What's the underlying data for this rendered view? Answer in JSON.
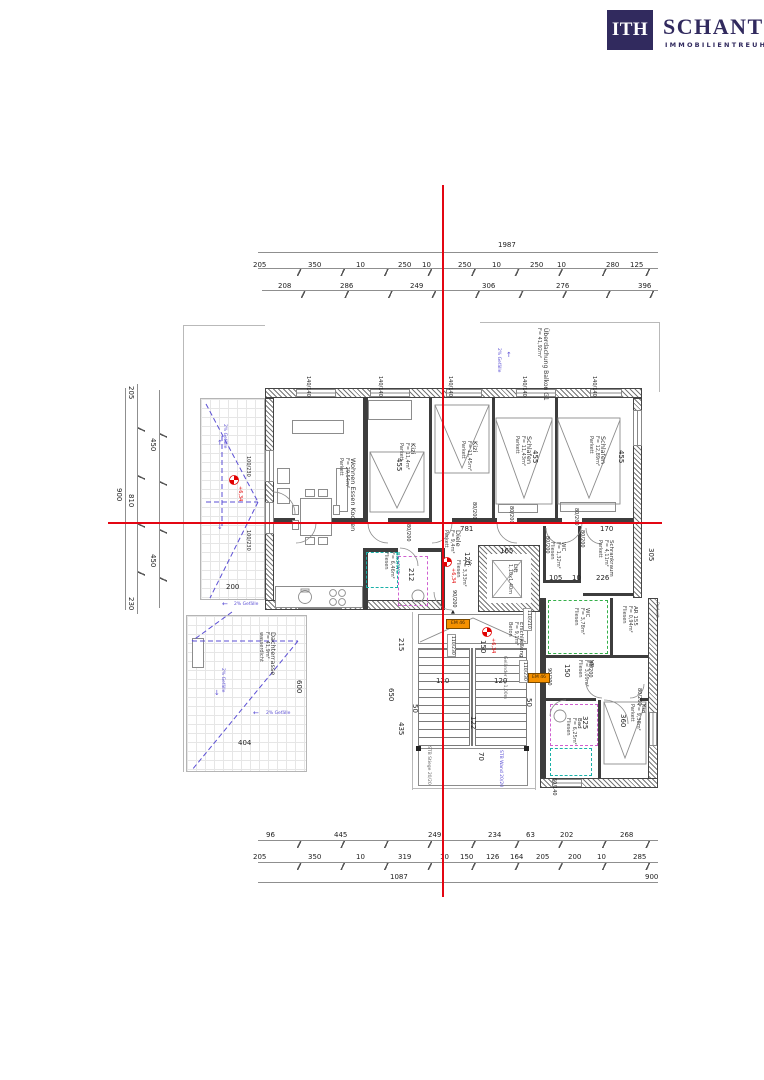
{
  "logo": {
    "abbr": "ITH",
    "name": "SCHANTL",
    "subtitle": "IMMOBILIENTREUHAND"
  },
  "dims": {
    "top": {
      "total": "1987",
      "row2": [
        "205",
        "350",
        "10",
        "250",
        "10",
        "250",
        "10",
        "250",
        "10",
        "280",
        "125"
      ],
      "row3": [
        "208",
        "286",
        "249",
        "306",
        "276",
        "396"
      ]
    },
    "bottom": {
      "row1": [
        "96",
        "445",
        "249",
        "234",
        "63",
        "202",
        "268"
      ],
      "row2": [
        "205",
        "350",
        "10",
        "319",
        "10",
        "150",
        "126",
        "164",
        "205",
        "200",
        "10",
        "285"
      ],
      "row3": [
        "1087",
        "900"
      ]
    },
    "left": {
      "total": "900",
      "segments": [
        "205",
        "450",
        "810",
        "450",
        "230"
      ]
    }
  },
  "rooms": {
    "wohnen": {
      "name": "Wohnen Essen Kochen",
      "area": "F= 29,54m²",
      "floor": "Parkett"
    },
    "kizi_a": {
      "name": "Kizi",
      "area": "F= 11,4m²",
      "floor": "Parkett"
    },
    "kizi_b": {
      "name": "Kizi",
      "area": "F= 11,45m²",
      "floor": "Parkett"
    },
    "schlafen_a": {
      "name": "Schlafen",
      "area": "F= 11,43m²",
      "floor": "Parkett"
    },
    "schlafen_b": {
      "name": "Schlafen",
      "area": "F= 12,89m²",
      "floor": "Parkett"
    },
    "diele": {
      "name": "Diele",
      "area": "F= 9,4m²",
      "floor": "Parkett"
    },
    "vr_a": {
      "name": "Vr.",
      "area": "F= 3,33m²",
      "floor": "Fliesen"
    },
    "lift": {
      "name": "Lift",
      "size": "1,10x1,40m"
    },
    "wc_a": {
      "name": "WC",
      "area": "F= 1,32m²",
      "floor": "Fliesen"
    },
    "schrankraum": {
      "name": "Schrankraum",
      "area": "F= 4,11m²",
      "floor": "Parkett"
    },
    "badwc": {
      "name": "Bad/WC",
      "area": "F= 6,46m²",
      "floor": "Fliesen"
    },
    "erschliessung": {
      "name": "Erschließung",
      "area": "F= 9,1m²",
      "floor": "Beton"
    },
    "wc_b": {
      "name": "WC",
      "area": "F= 3,78m²",
      "floor": "Fliesen"
    },
    "ar": {
      "name": "AR 155",
      "area": "F= 0,94m²",
      "floor": "Fliesen"
    },
    "vr_b": {
      "name": "VR",
      "area": "F= 3,09m²",
      "floor": "Fliesen"
    },
    "bad": {
      "name": "Bad",
      "area": "F= 6,25m²",
      "floor": "Fliesen"
    },
    "kizi_c": {
      "name": "Kizi",
      "area": "F= 9,38m²",
      "floor": "Parkett"
    },
    "dachterrasse": {
      "name": "Dachterrasse",
      "area": "F= 41,9m²",
      "note": "wasserdicht"
    },
    "balkon": {
      "name": "Überdachung Balkon G1",
      "area": "F= 41,92m²"
    }
  },
  "plan_dims": {
    "w455": "455",
    "w781": "781",
    "w170": "170",
    "h305": "305",
    "h120": "120",
    "w105": "105",
    "w10": "10",
    "w226": "226",
    "w165": "165",
    "h212": "212",
    "h215": "215",
    "h650": "650",
    "h435": "435",
    "w120": "120",
    "h50": "50",
    "h122": "122",
    "h70": "70",
    "h150": "150",
    "h600": "600",
    "w404": "404",
    "w200": "200",
    "h325": "325",
    "h360": "360",
    "h150b": "150"
  },
  "openings": {
    "door80": "80/200",
    "door90": "90/200",
    "win140": "140/140",
    "win100": "100/230",
    "win110": "110/230",
    "win110b": "110/210",
    "win60": "60/140"
  },
  "marks": {
    "level": "+6,34",
    "slope": "2% Gefälle",
    "badge": "EM 46",
    "railing": "Geländer h=1,00m",
    "stb_stiege": "STB Stiege 20/20",
    "stb_wand": "STB Wand 20/20",
    "parkett": "Parkett"
  },
  "icons": {
    "up": "↑",
    "down": "↓",
    "left": "←",
    "tri": "▲"
  }
}
